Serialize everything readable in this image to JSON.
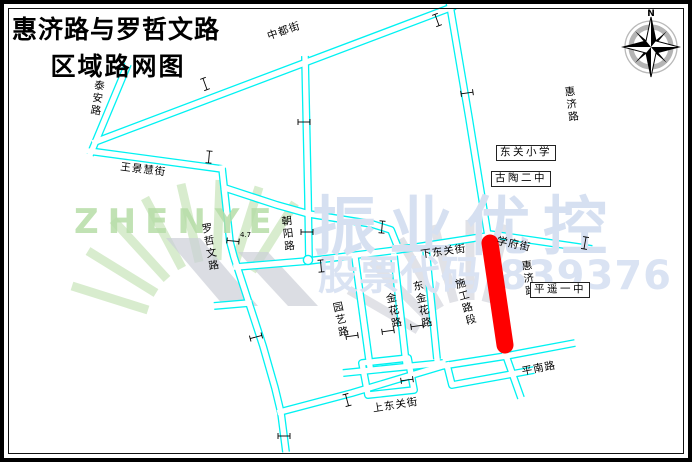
{
  "title": {
    "line1": "惠济路与罗哲文路",
    "line2": "区域路网图"
  },
  "compass": {
    "north_label": "N"
  },
  "watermarks": {
    "brand_latin": "ZHENYE",
    "brand_cn": "振业优控",
    "stock_code": "股票代码:839376"
  },
  "road_labels": [
    {
      "id": "taian-road",
      "text": "泰安路"
    },
    {
      "id": "zhongdu-street",
      "text": "中都街"
    },
    {
      "id": "huiji-road-north",
      "text": "惠济路"
    },
    {
      "id": "wangjinghui-street",
      "text": "王景慧街"
    },
    {
      "id": "luozhewen-road",
      "text": "罗哲文路"
    },
    {
      "id": "chaoyang-road",
      "text": "朝阳路"
    },
    {
      "id": "xiadongguan-street",
      "text": "下东关街"
    },
    {
      "id": "xuefu-street",
      "text": "学府街"
    },
    {
      "id": "huiji-road-south",
      "text": "惠济路"
    },
    {
      "id": "construction-section",
      "text": "施工路段"
    },
    {
      "id": "yuanyi-road",
      "text": "园艺路"
    },
    {
      "id": "jinhua-road",
      "text": "金花路"
    },
    {
      "id": "dongjinhua-road",
      "text": "东金花路"
    },
    {
      "id": "shangdongguan-street",
      "text": "上东关街"
    },
    {
      "id": "pingnan-road",
      "text": "平南路"
    }
  ],
  "poi_labels": [
    {
      "id": "dongguan-primary-school",
      "text": "东关小学"
    },
    {
      "id": "gutao-no2-middle-school",
      "text": "古陶二中"
    },
    {
      "id": "pingyao-no1-middle-school",
      "text": "平遥一中"
    }
  ],
  "annotations": {
    "dimension_value": "4.7"
  },
  "colors": {
    "road_line": "#00f2f2",
    "construction_segment": "#ff0000",
    "watermark_green": "#bfe0ae",
    "watermark_blue": "#d9e2f2"
  }
}
